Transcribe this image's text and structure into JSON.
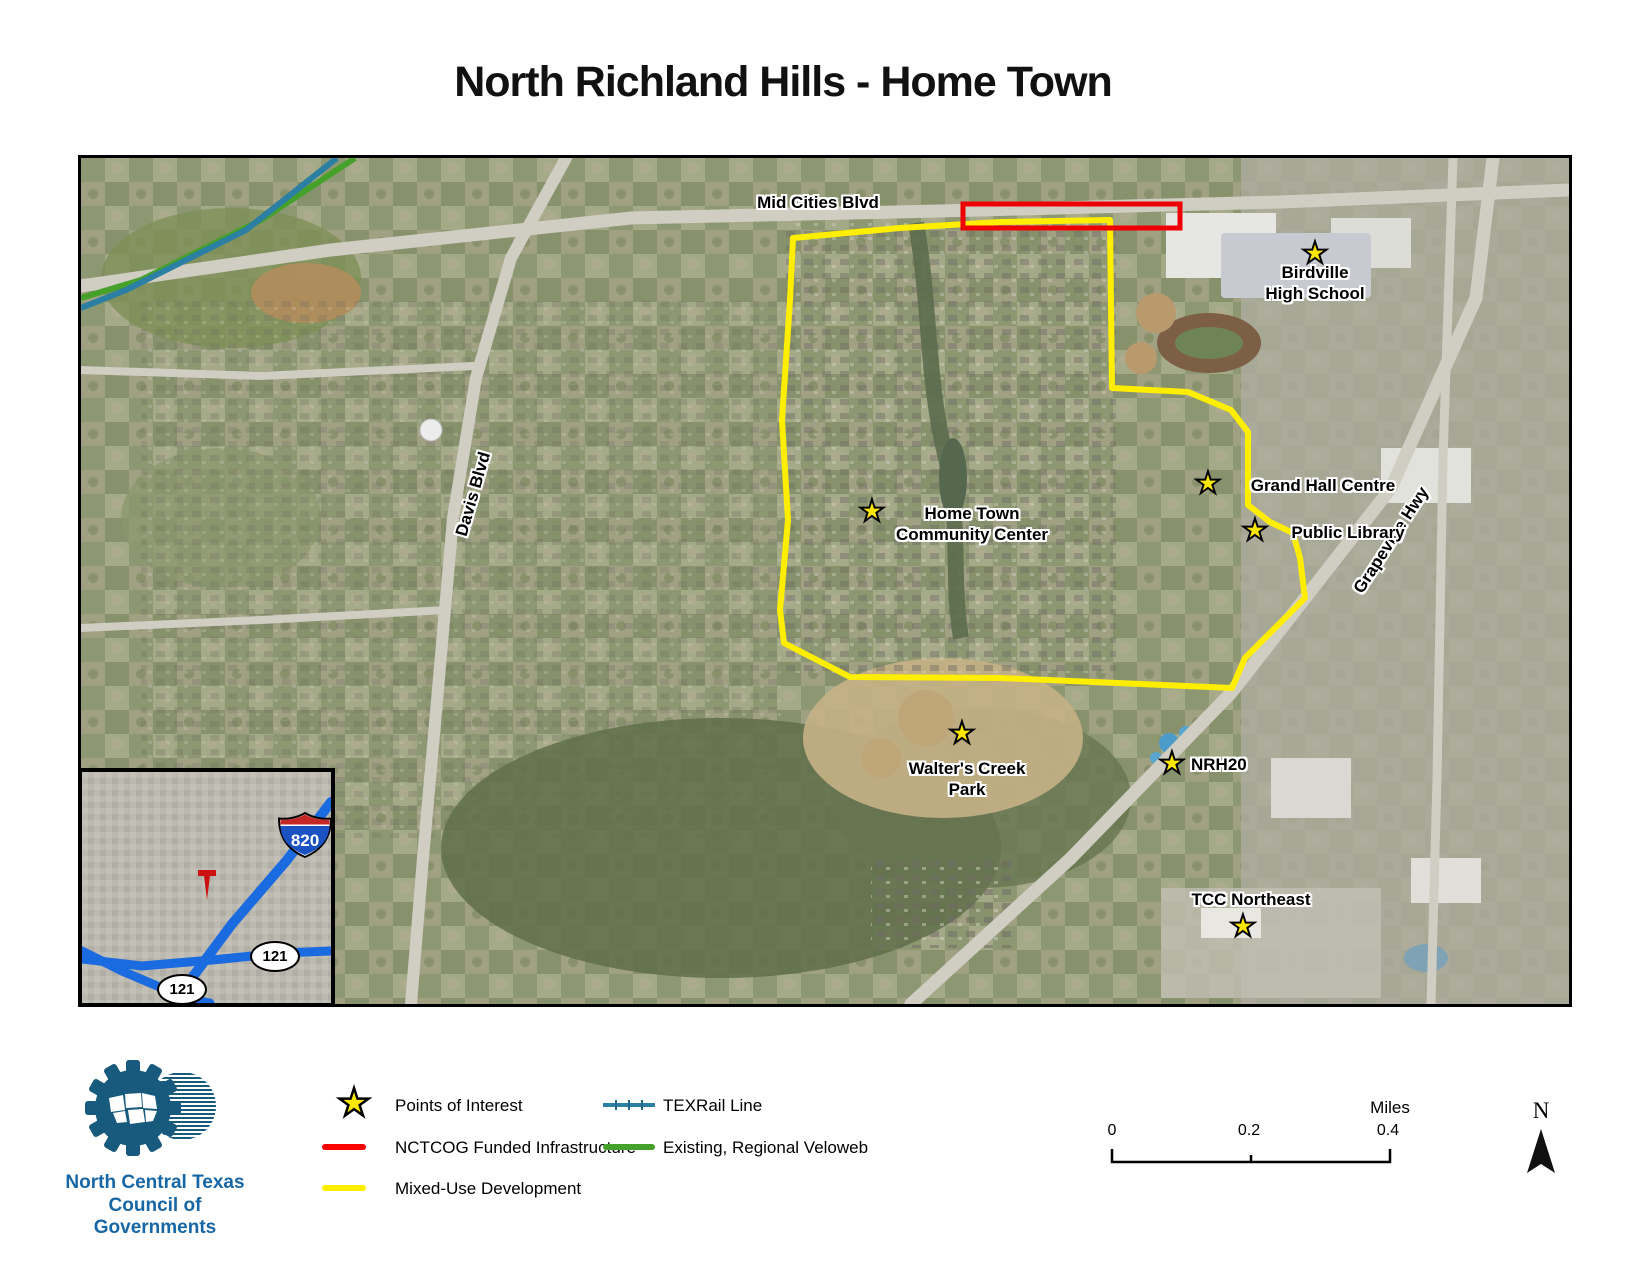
{
  "title": "North Richland Hills - Home Town",
  "icons": {
    "star": "★"
  },
  "map": {
    "road_labels": {
      "mid_cities": "Mid Cities Blvd",
      "davis": "Davis Blvd",
      "grapevine": "Grapevine Hwy"
    },
    "pois": [
      {
        "name": "birdville-high-school",
        "lines": [
          "Birdville",
          "High School"
        ]
      },
      {
        "name": "grand-hall-centre",
        "lines": [
          "Grand Hall Centre"
        ]
      },
      {
        "name": "public-library",
        "lines": [
          "Public Library"
        ]
      },
      {
        "name": "home-town-community-center",
        "lines": [
          "Home Town",
          "Community Center"
        ]
      },
      {
        "name": "walters-creek-park",
        "lines": [
          "Walter's Creek",
          "Park"
        ]
      },
      {
        "name": "nrh20",
        "lines": [
          "NRH20"
        ]
      },
      {
        "name": "tcc-northeast",
        "lines": [
          "TCC Northeast"
        ]
      }
    ],
    "inset": {
      "interstate_shield": "820",
      "state_shield_1": "121",
      "state_shield_2": "121"
    }
  },
  "legend": {
    "points_of_interest": "Points of Interest",
    "nctcog": "NCTCOG Funded Infrastructure",
    "mixed_use": "Mixed-Use Development",
    "texrail": "TEXRail Line",
    "veloweb": "Existing, Regional Veloweb",
    "colors": {
      "poi_star": "#ffe800",
      "nctcog_red": "#ff0000",
      "mixed_use_yellow": "#ffee00",
      "texrail_blue": "#2b7fa3",
      "veloweb_green": "#46a12b",
      "inset_highway_blue": "#1a6ae0",
      "logo_blue": "#1766a5"
    }
  },
  "scale": {
    "t0": "0",
    "t1": "0.2",
    "t2": "0.4",
    "unit": "Miles"
  },
  "north": {
    "label": "N"
  },
  "logo": {
    "line1": "North Central Texas",
    "line2": "Council of Governments"
  }
}
